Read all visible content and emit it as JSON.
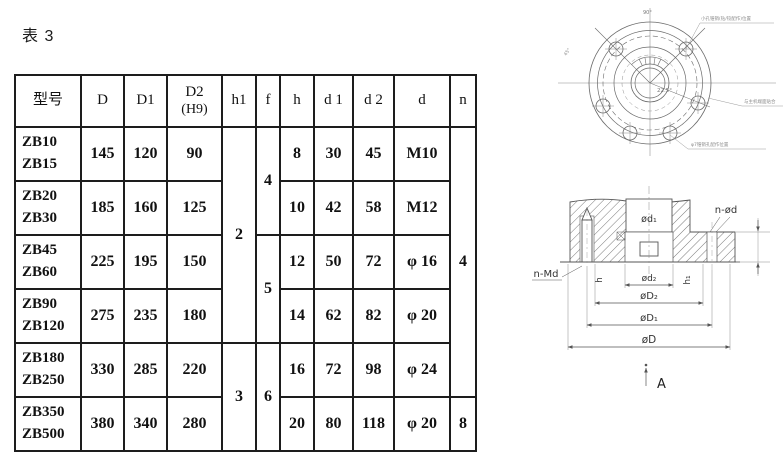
{
  "page": {
    "title": "表 3"
  },
  "table": {
    "columns": [
      [
        "model",
        "型号"
      ],
      [
        "D",
        "D"
      ],
      [
        "D1",
        "D1"
      ],
      [
        "D2",
        "D2",
        "(H9)"
      ],
      [
        "h1",
        "h1"
      ],
      [
        "f",
        "f"
      ],
      [
        "h",
        "h"
      ],
      [
        "d1",
        "d 1"
      ],
      [
        "d2",
        "d 2"
      ],
      [
        "d",
        "d"
      ],
      [
        "n",
        "n"
      ]
    ],
    "rows": [
      [
        [
          "model",
          "ZB10\nZB15"
        ],
        [
          "D",
          "145"
        ],
        [
          "D1",
          "120"
        ],
        [
          "D2",
          "90"
        ],
        [
          "h1",
          "2",
          4
        ],
        [
          "f",
          "4",
          2
        ],
        [
          "h",
          "8"
        ],
        [
          "d1",
          "30"
        ],
        [
          "d2",
          "45"
        ],
        [
          "d",
          "M10"
        ],
        [
          "n",
          "4",
          5
        ]
      ],
      [
        [
          "model",
          "ZB20\nZB30"
        ],
        [
          "D",
          "185"
        ],
        [
          "D1",
          "160"
        ],
        [
          "D2",
          "125"
        ],
        [
          "h",
          "10"
        ],
        [
          "d1",
          "42"
        ],
        [
          "d2",
          "58"
        ],
        [
          "d",
          "M12"
        ]
      ],
      [
        [
          "model",
          "ZB45\nZB60"
        ],
        [
          "D",
          "225"
        ],
        [
          "D1",
          "195"
        ],
        [
          "D2",
          "150"
        ],
        [
          "f",
          "5",
          2
        ],
        [
          "h",
          "12"
        ],
        [
          "d1",
          "50"
        ],
        [
          "d2",
          "72"
        ],
        [
          "d",
          "φ 16"
        ]
      ],
      [
        [
          "model",
          "ZB90\nZB120"
        ],
        [
          "D",
          "275"
        ],
        [
          "D1",
          "235"
        ],
        [
          "D2",
          "180"
        ],
        [
          "h",
          "14"
        ],
        [
          "d1",
          "62"
        ],
        [
          "d2",
          "82"
        ],
        [
          "d",
          "φ 20"
        ]
      ],
      [
        [
          "model",
          "ZB180\nZB250"
        ],
        [
          "D",
          "330"
        ],
        [
          "D1",
          "285"
        ],
        [
          "D2",
          "220"
        ],
        [
          "h1",
          "3",
          2
        ],
        [
          "f",
          "6",
          2
        ],
        [
          "h",
          "16"
        ],
        [
          "d1",
          "72"
        ],
        [
          "d2",
          "98"
        ],
        [
          "d",
          "φ 24"
        ]
      ],
      [
        [
          "model",
          "ZB350\nZB500"
        ],
        [
          "D",
          "380"
        ],
        [
          "D1",
          "340"
        ],
        [
          "D2",
          "280"
        ],
        [
          "h",
          "20"
        ],
        [
          "d1",
          "80"
        ],
        [
          "d2",
          "118"
        ],
        [
          "d",
          "φ 20"
        ],
        [
          "n",
          "8"
        ]
      ]
    ]
  },
  "topview": {
    "labels": {
      "angle_top": "90°",
      "angle_225": "22.5°",
      "angle_45": "45°"
    },
    "annotations": [
      "小孔锥销(钻/铰配作)位置",
      "与主机端面贴合",
      "φ7锥销孔配作位置"
    ]
  },
  "section": {
    "labels": {
      "n_od": "n-ød",
      "n_md": "n-Md",
      "d1": "ød₁",
      "d2": "ød₂",
      "D2": "øD₂",
      "D1": "øD₁",
      "D": "øD",
      "h": "h",
      "h1": "h₁",
      "A": "A"
    }
  }
}
